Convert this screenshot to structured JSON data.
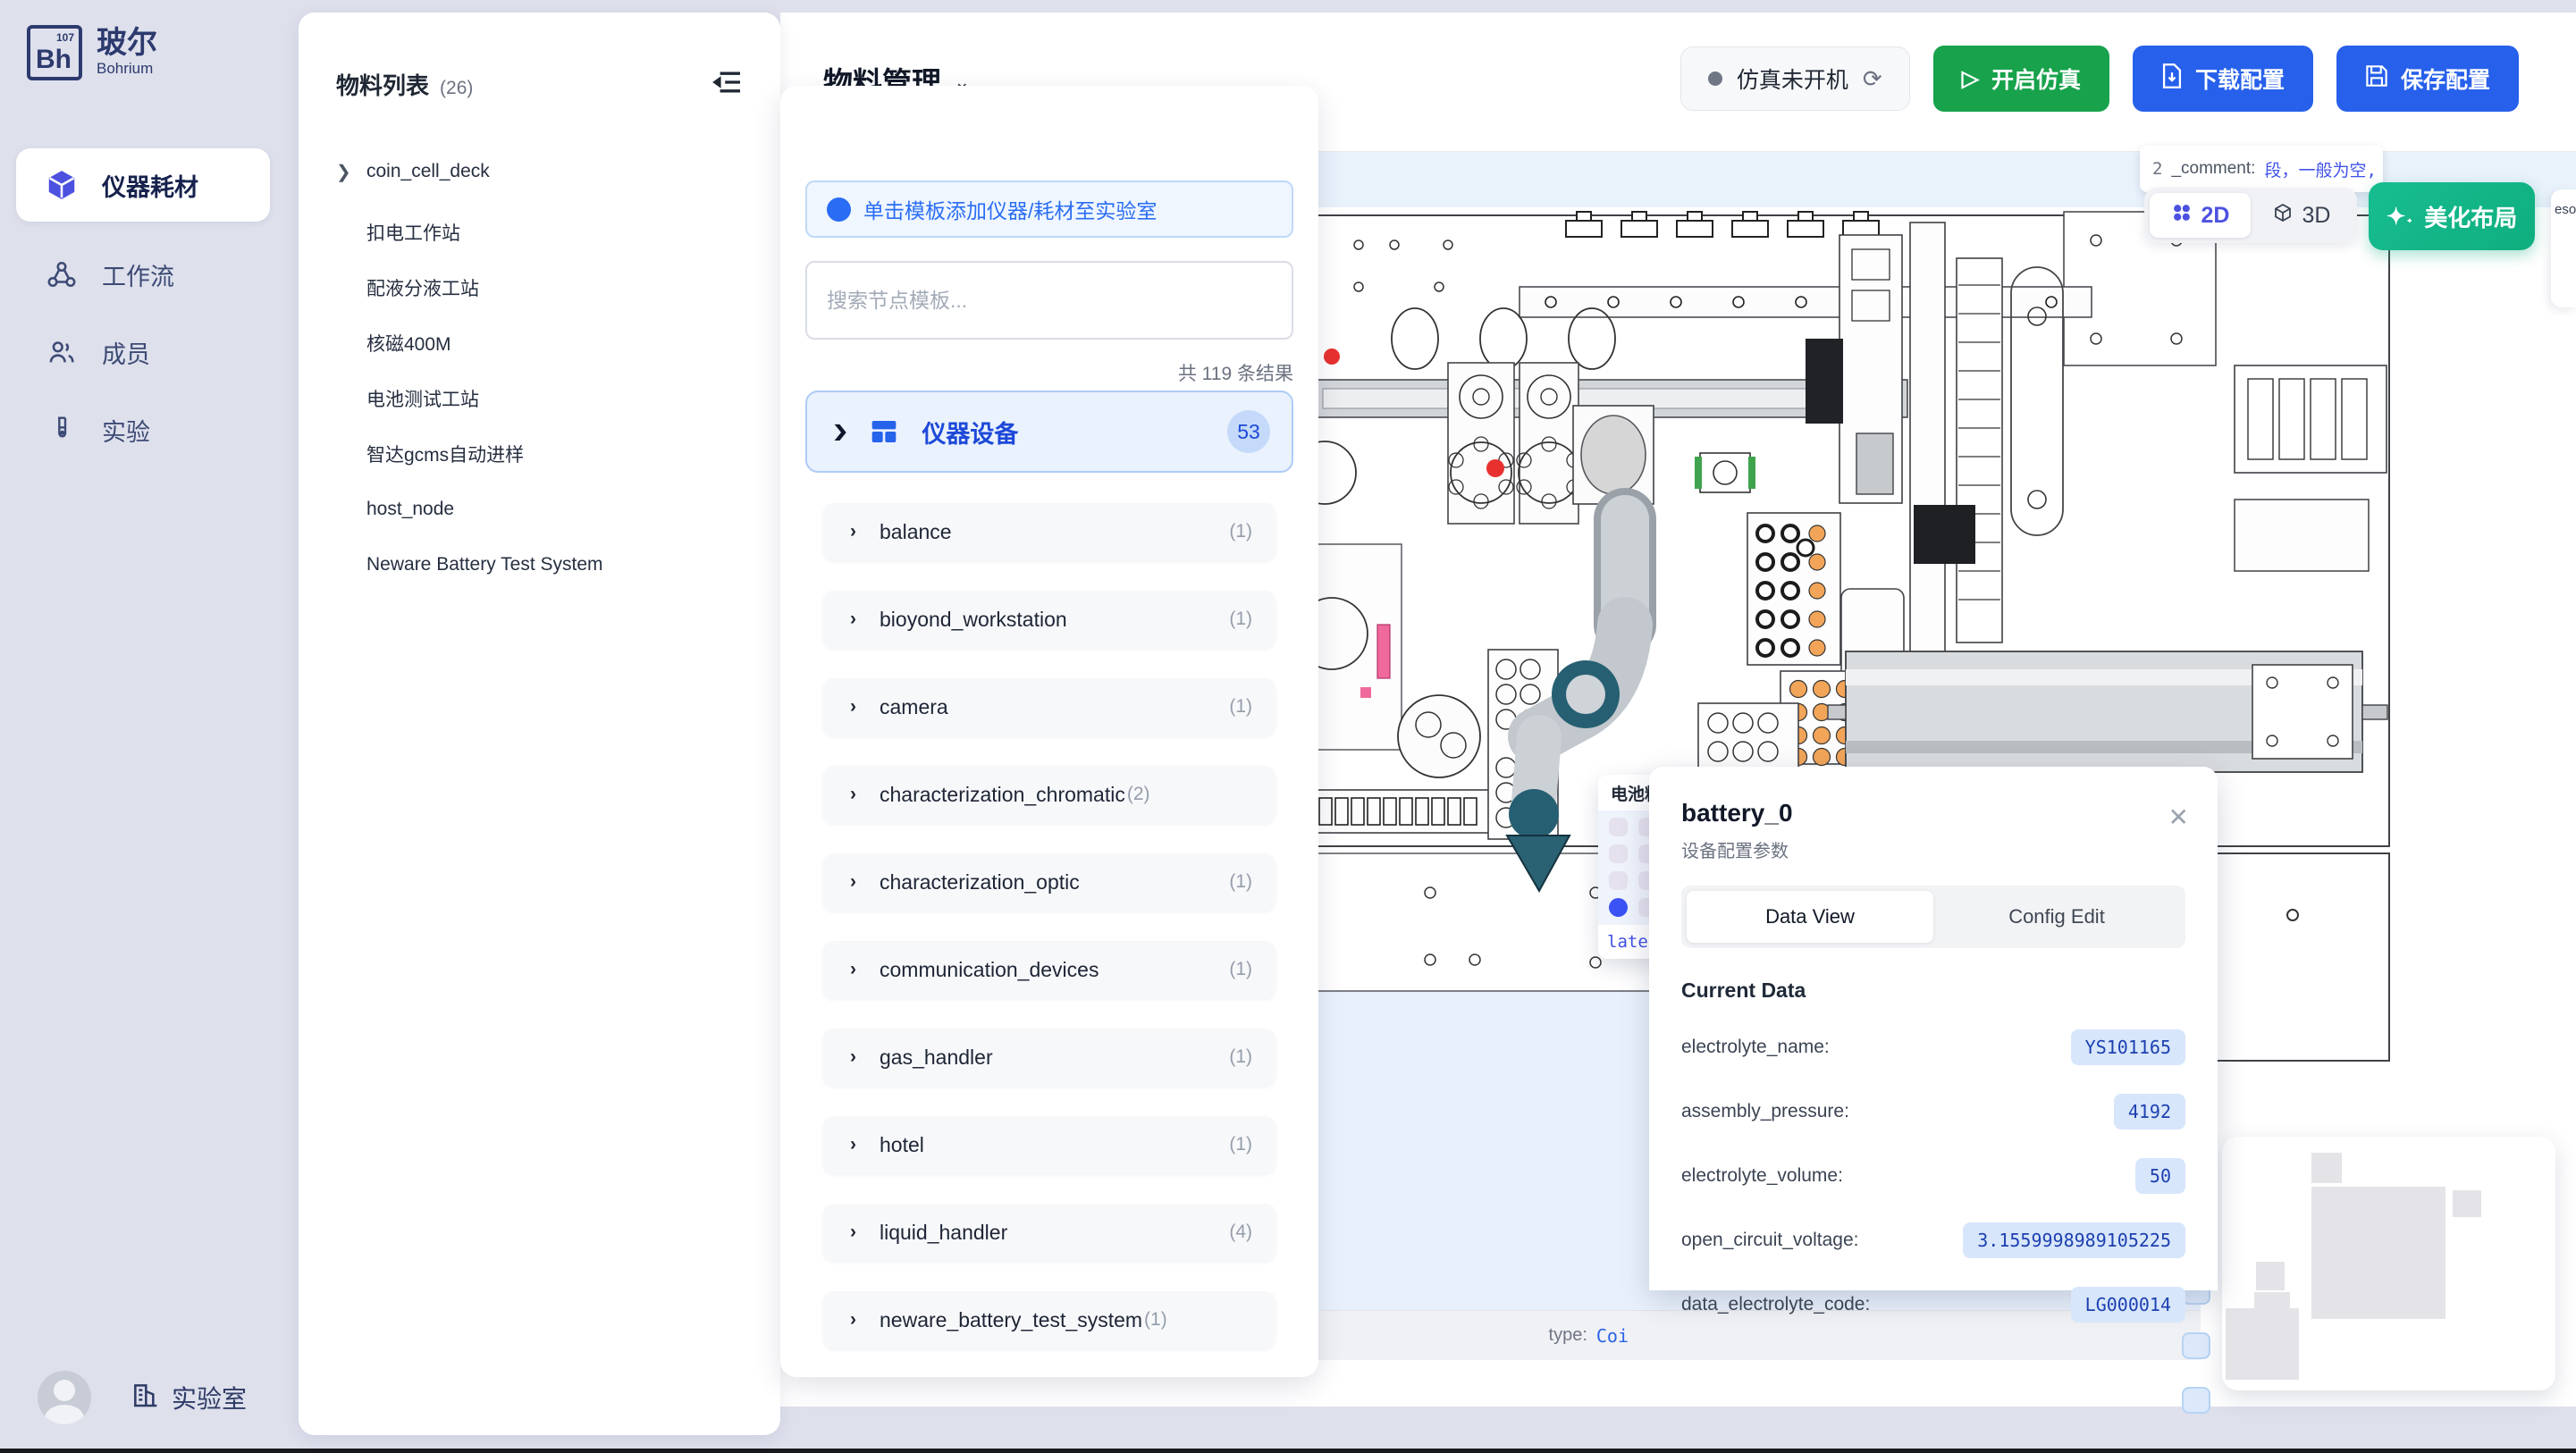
{
  "app": {
    "logo_text": "Bh",
    "logo_sup": "107",
    "brand_cn": "玻尔",
    "brand_en": "Bohrium"
  },
  "sidebar": {
    "items": [
      {
        "label": "仪器耗材"
      },
      {
        "label": "工作流"
      },
      {
        "label": "成员"
      },
      {
        "label": "实验"
      }
    ],
    "lab_label": "实验室"
  },
  "materials_panel": {
    "title": "物料列表",
    "count": "(26)",
    "items": [
      "coin_cell_deck",
      "扣电工作站",
      "配液分液工站",
      "核磁400M",
      "电池测试工站",
      "智达gcms自动进样",
      "host_node",
      "Neware Battery Test System"
    ]
  },
  "header": {
    "title": "物料管理",
    "status_label": "仿真未开机",
    "start_button": "开启仿真",
    "download_button": "下载配置",
    "save_button": "保存配置"
  },
  "template_panel": {
    "banner": "单击模板添加仪器/耗材至实验室",
    "search_placeholder": "搜索节点模板...",
    "result_count": "共 119 条结果",
    "section": {
      "label": "仪器设备",
      "badge": "53"
    },
    "items": [
      {
        "name": "balance",
        "count": "(1)"
      },
      {
        "name": "bioyond_workstation",
        "count": "(1)"
      },
      {
        "name": "camera",
        "count": "(1)"
      },
      {
        "name": "characterization_chromatic",
        "count": "(2)"
      },
      {
        "name": "characterization_optic",
        "count": "(1)"
      },
      {
        "name": "communication_devices",
        "count": "(1)"
      },
      {
        "name": "gas_handler",
        "count": "(1)"
      },
      {
        "name": "hotel",
        "count": "(1)"
      },
      {
        "name": "liquid_handler",
        "count": "(4)"
      },
      {
        "name": "neware_battery_test_system",
        "count": "(1)"
      }
    ]
  },
  "canvas": {
    "view_2d": "2D",
    "view_3d": "3D",
    "beautify_button": "美化布局",
    "comment_prefix": "2",
    "comment_key": "_comment:",
    "comment_value": "段，一般为空, stat",
    "edge_fragment": "esou",
    "zone_caption_key": "type:",
    "zone_caption_value": "Coi",
    "tray_popup": {
      "title": "电池料盘",
      "caption": "late"
    }
  },
  "device_popup": {
    "title": "battery_0",
    "subtitle": "设备配置参数",
    "tab_data": "Data View",
    "tab_config": "Config Edit",
    "section": "Current Data",
    "fields": [
      {
        "label": "electrolyte_name:",
        "value": "YS101165"
      },
      {
        "label": "assembly_pressure:",
        "value": "4192"
      },
      {
        "label": "electrolyte_volume:",
        "value": "50"
      },
      {
        "label": "open_circuit_voltage:",
        "value": "3.1559998989105225"
      },
      {
        "label": "data_electrolyte_code:",
        "value": "LG000014"
      }
    ]
  }
}
